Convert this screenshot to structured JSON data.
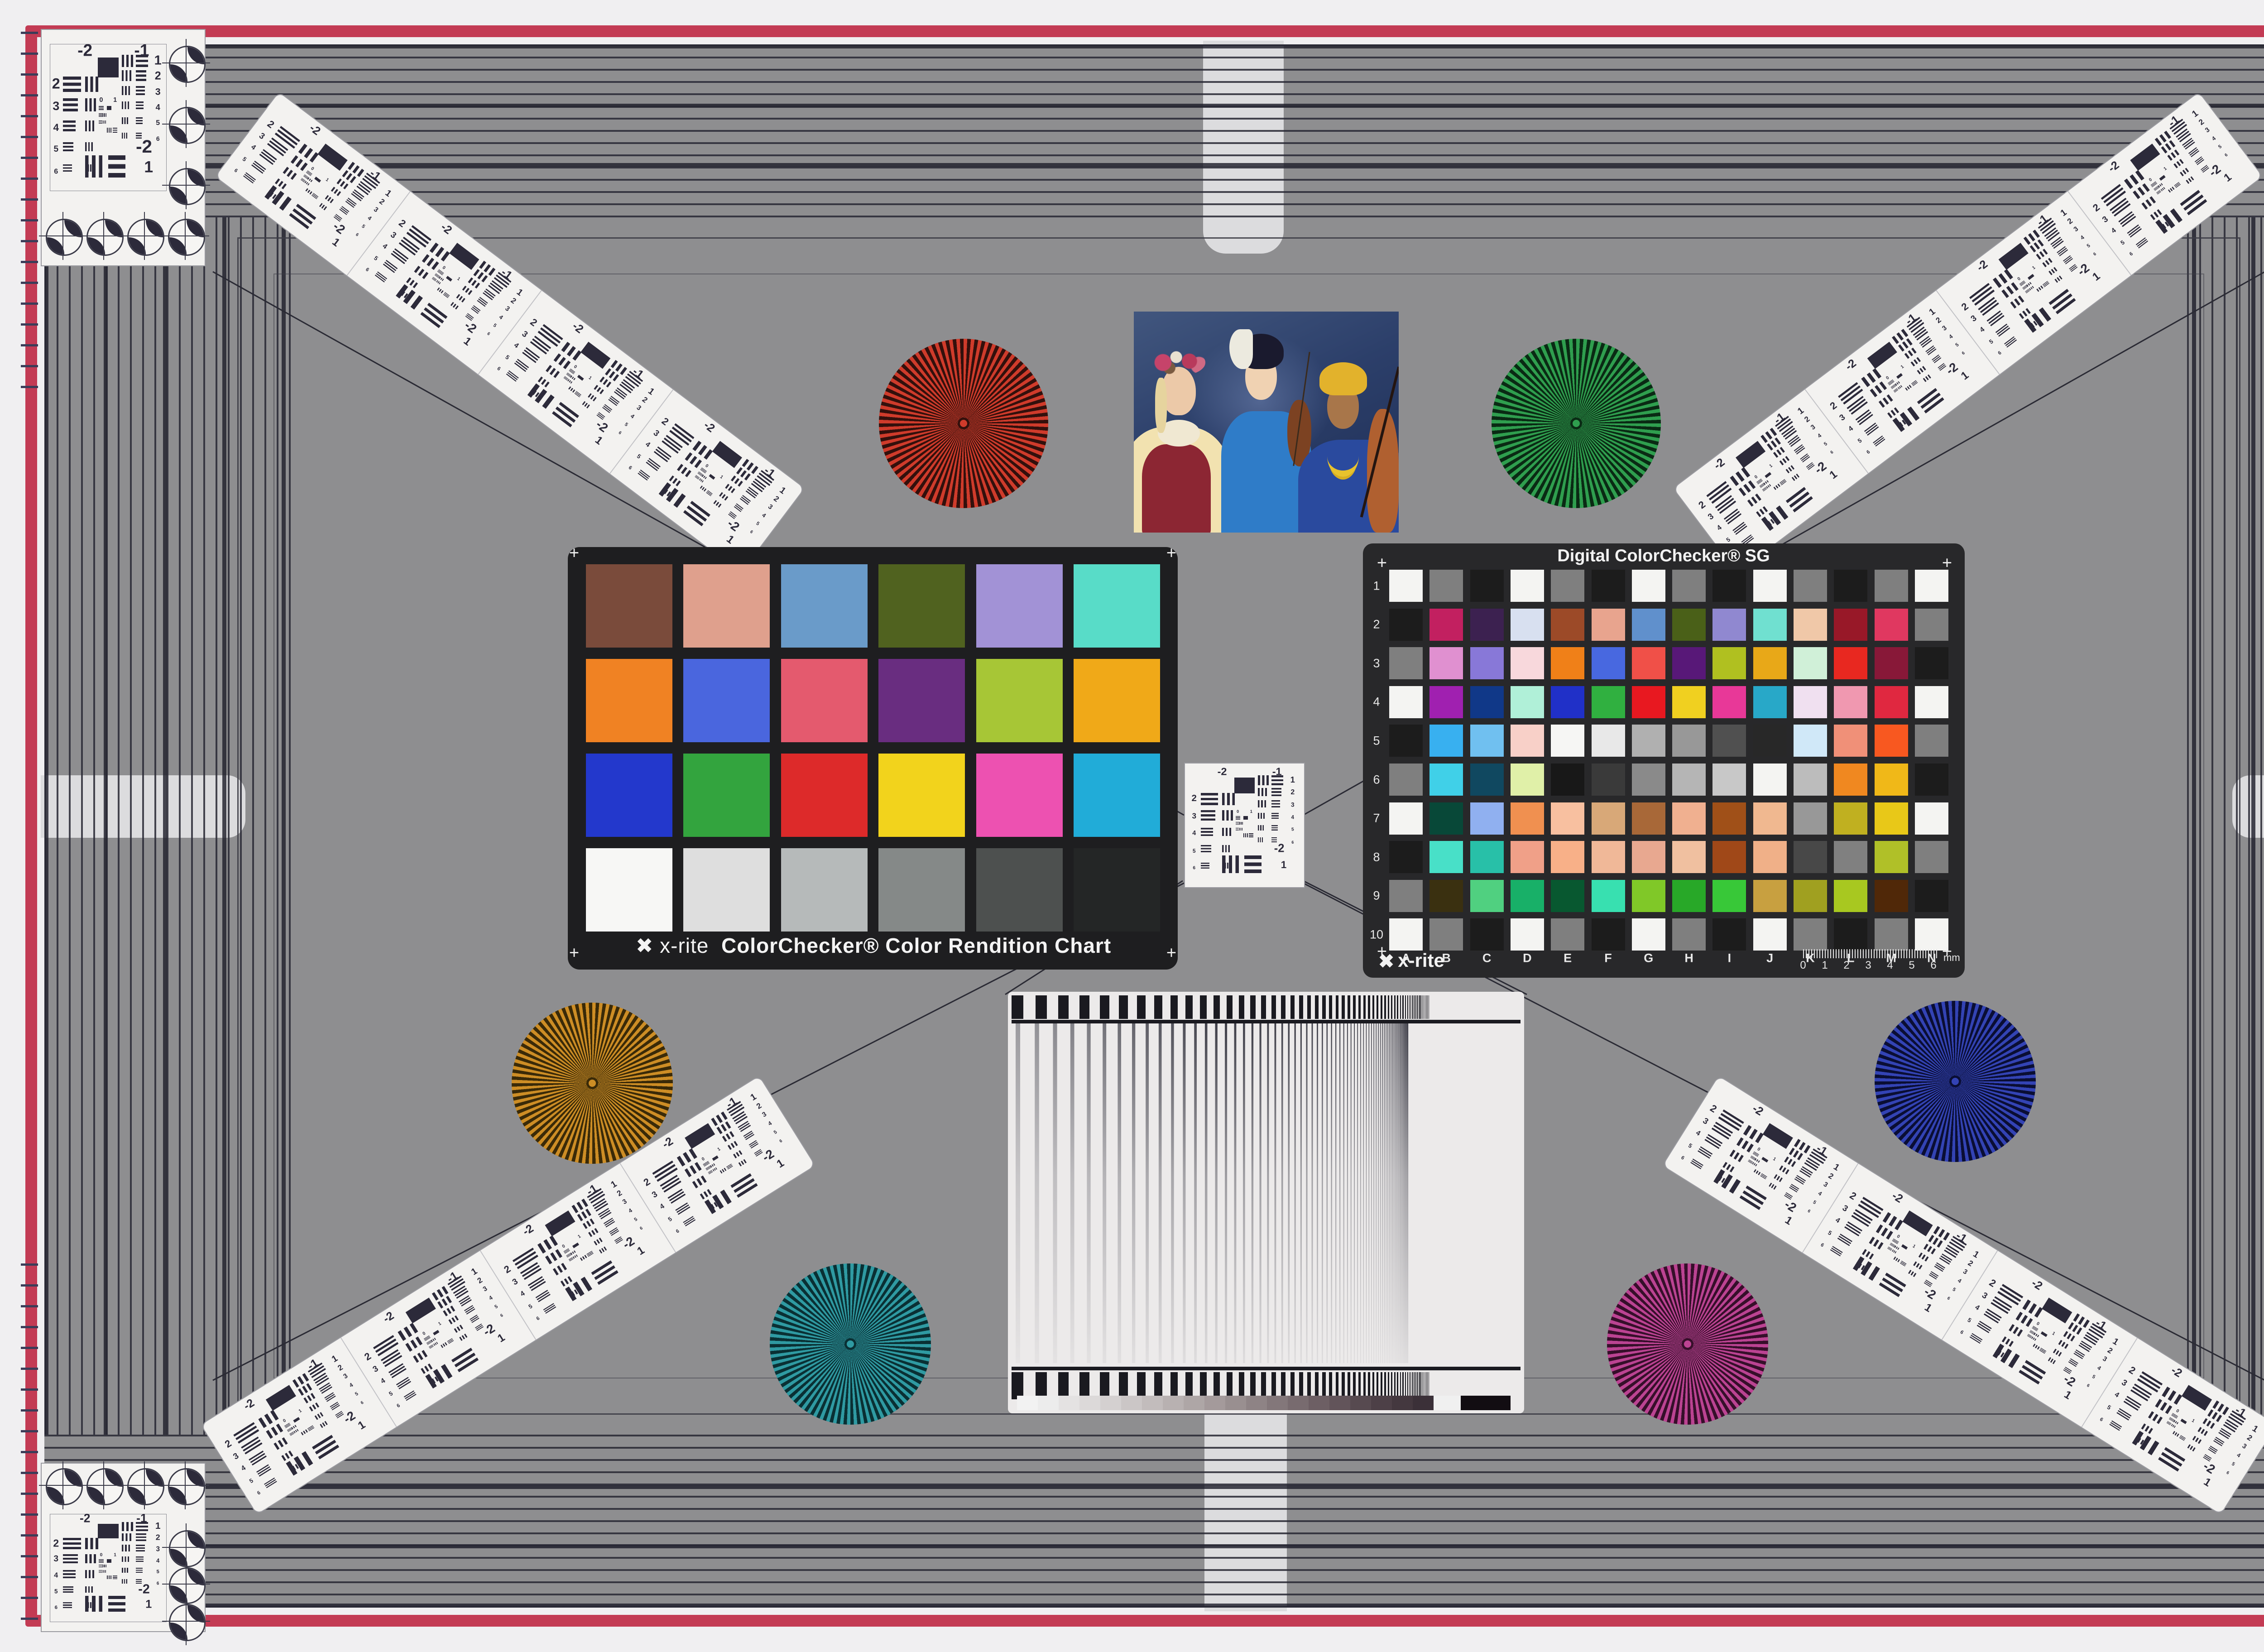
{
  "scene": {
    "description": "Camera studio test chart: gray frame with striped border, two X-Rite color charts, USAF-1951 resolution targets, Siemens stars, frequency sweep chart and portrait photo",
    "field_color": "#8e8e90",
    "band_line_color": "#2f2f39",
    "red_frame_color": "#c33b54",
    "margin_color": "#f0eff1",
    "tab_color": "#dcdcde",
    "diag_line_color": "#2a2a34"
  },
  "colorchecker": {
    "brand": "x-rite",
    "logo_glyph": "✖",
    "label": "ColorChecker® Color Rendition Chart",
    "patches": [
      "#7a4b3b",
      "#dfa08d",
      "#6a9bc9",
      "#50621f",
      "#a292d6",
      "#58dcc8",
      "#f08223",
      "#4a66de",
      "#e45a6e",
      "#692d80",
      "#a7c636",
      "#f0a918",
      "#2338cc",
      "#33a43e",
      "#dd2a2a",
      "#f2d31c",
      "#ed51b1",
      "#21acd8",
      "#f7f7f5",
      "#dedede",
      "#b6baba",
      "#858988",
      "#4d504f",
      "#242626"
    ]
  },
  "sg": {
    "title": "Digital ColorChecker® SG",
    "brand": "x-rite",
    "logo_glyph": "✖",
    "row_labels": [
      "1",
      "2",
      "3",
      "4",
      "5",
      "6",
      "7",
      "8",
      "9",
      "10"
    ],
    "col_labels": [
      "A",
      "B",
      "C",
      "D",
      "E",
      "F",
      "G",
      "H",
      "I",
      "J",
      "K",
      "L",
      "M",
      "N"
    ],
    "ruler_numbers": [
      "0",
      "1",
      "2",
      "3",
      "4",
      "5",
      "6"
    ],
    "ruler_unit": "mm",
    "rows": [
      [
        "#f4f4f2",
        "#7f7f7f",
        "#1c1c1c",
        "#f4f4f2",
        "#7f7f7f",
        "#1c1c1c",
        "#f4f4f2",
        "#7f7f7f",
        "#1c1c1c",
        "#f4f4f2",
        "#7f7f7f",
        "#1c1c1c",
        "#7f7f7f",
        "#f4f4f2"
      ],
      [
        "#1c1c1c",
        "#c22060",
        "#3c2150",
        "#d8e0f0",
        "#9c4a28",
        "#e8a48e",
        "#6090cc",
        "#4a6018",
        "#9088d0",
        "#70e0d0",
        "#f0c8a8",
        "#981828",
        "#e03860",
        "#7f7f7f"
      ],
      [
        "#7f7f7f",
        "#e090d0",
        "#8878d8",
        "#f8d8dc",
        "#f08018",
        "#4868e0",
        "#f05048",
        "#581878",
        "#b0c020",
        "#e8a818",
        "#d0f0d8",
        "#e82820",
        "#881838",
        "#1c1c1c"
      ],
      [
        "#f4f4f2",
        "#a020b0",
        "#103888",
        "#b0f0d8",
        "#2030c8",
        "#30b040",
        "#e81820",
        "#f0d020",
        "#e83898",
        "#28a8c8",
        "#f0e0f0",
        "#f098b0",
        "#e02840",
        "#f4f4f2"
      ],
      [
        "#1c1c1c",
        "#38b0f0",
        "#70c0f0",
        "#f8d0c8",
        "#f6f6f4",
        "#e8e8e8",
        "#b0b0b0",
        "#989898",
        "#505050",
        "#282828",
        "#d0e8f8",
        "#f09078",
        "#f85820",
        "#7f7f7f"
      ],
      [
        "#7f7f7f",
        "#40d0e8",
        "#104860",
        "#e0f0a8",
        "#181818",
        "#3a3a3a",
        "#8a8a8a",
        "#b5b5b5",
        "#c8c8c8",
        "#f4f4f2",
        "#bcbcbc",
        "#f08820",
        "#f0b818",
        "#1c1c1c"
      ],
      [
        "#f4f4f2",
        "#084838",
        "#90b0f0",
        "#f09050",
        "#f8c0a0",
        "#d8a878",
        "#a86838",
        "#f0b090",
        "#a05018",
        "#f0b890",
        "#989898",
        "#c0b020",
        "#e8c818",
        "#f4f4f2"
      ],
      [
        "#1c1c1c",
        "#48e0c8",
        "#28c0a8",
        "#f0a088",
        "#f8b088",
        "#f0b898",
        "#e8a890",
        "#f0c0a0",
        "#a04818",
        "#f0b088",
        "#484848",
        "#808080",
        "#b0c028",
        "#7f7f7f"
      ],
      [
        "#7f7f7f",
        "#3a3010",
        "#50d080",
        "#18b068",
        "#085830",
        "#38e0b0",
        "#80c828",
        "#28a828",
        "#38c838",
        "#c8a040",
        "#a0a020",
        "#a8c820",
        "#502808",
        "#1c1c1c"
      ],
      [
        "#f4f4f2",
        "#7f7f7f",
        "#1c1c1c",
        "#f4f4f2",
        "#7f7f7f",
        "#1c1c1c",
        "#f4f4f2",
        "#7f7f7f",
        "#1c1c1c",
        "#f4f4f2",
        "#7f7f7f",
        "#1c1c1c",
        "#7f7f7f",
        "#f4f4f2"
      ]
    ]
  },
  "usaf": {
    "top_labels": [
      "-2",
      "-1"
    ],
    "left_numbers": [
      "2",
      "3",
      "4",
      "5",
      "6"
    ],
    "right_numbers": [
      "1",
      "2",
      "3",
      "4",
      "5",
      "6"
    ],
    "bottom_labels": [
      "-2",
      "1"
    ],
    "center_labels": [
      "0",
      "1"
    ],
    "ink": "#2c2a3a"
  },
  "stars": [
    {
      "name": "red-star",
      "bright": "#cf3b2b",
      "dark": "#33100c"
    },
    {
      "name": "green-star",
      "bright": "#2f9e4e",
      "dark": "#0a2a14"
    },
    {
      "name": "amber-star",
      "bright": "#cd8d25",
      "dark": "#3a2a08"
    },
    {
      "name": "blue-star",
      "bright": "#3343b4",
      "dark": "#0a0e34"
    },
    {
      "name": "teal-star",
      "bright": "#2f9aa2",
      "dark": "#0a3034"
    },
    {
      "name": "magenta-star",
      "bright": "#bb4392",
      "dark": "#360f2a"
    }
  ],
  "sweep_chart": {
    "bar_color": "#1a1a20",
    "line_color": "#3f3f49",
    "steps": [
      "#f2f2f2",
      "#ececec",
      "#e4e2e2",
      "#dcd9d9",
      "#d4d0d0",
      "#cbc6c6",
      "#c2bcbc",
      "#b8b1b1",
      "#aea6a6",
      "#a49a9b",
      "#998f90",
      "#8e8385",
      "#83777a",
      "#786b6f",
      "#6d5f64",
      "#62545a",
      "#574a50",
      "#4d4047",
      "#44383f",
      "#3b3038"
    ],
    "step_end_white": "#f0f0f0",
    "step_end_black": "#120d12"
  },
  "photo": {
    "description": "Three women musicians with violins and cello against blue backdrop",
    "background": "#2c3f6a",
    "skin_left": "#ecc9a8",
    "hair_left": "#e6d49e",
    "flower_crown": "#c6436a",
    "vest": "#8c2633",
    "blouse": "#f2e2b0",
    "collar": "#f0e8d2",
    "kimono": "#2f7cc8",
    "hair_middle": "#1a1a2e",
    "headdress": "#eceadf",
    "skin_middle": "#f0d2b2",
    "turban": "#e2b22c",
    "skin_right": "#a8764a",
    "robe": "#2a4a9e",
    "necklace": "#e8c22c",
    "cello": "#b06030",
    "violin": "#7c4222"
  }
}
